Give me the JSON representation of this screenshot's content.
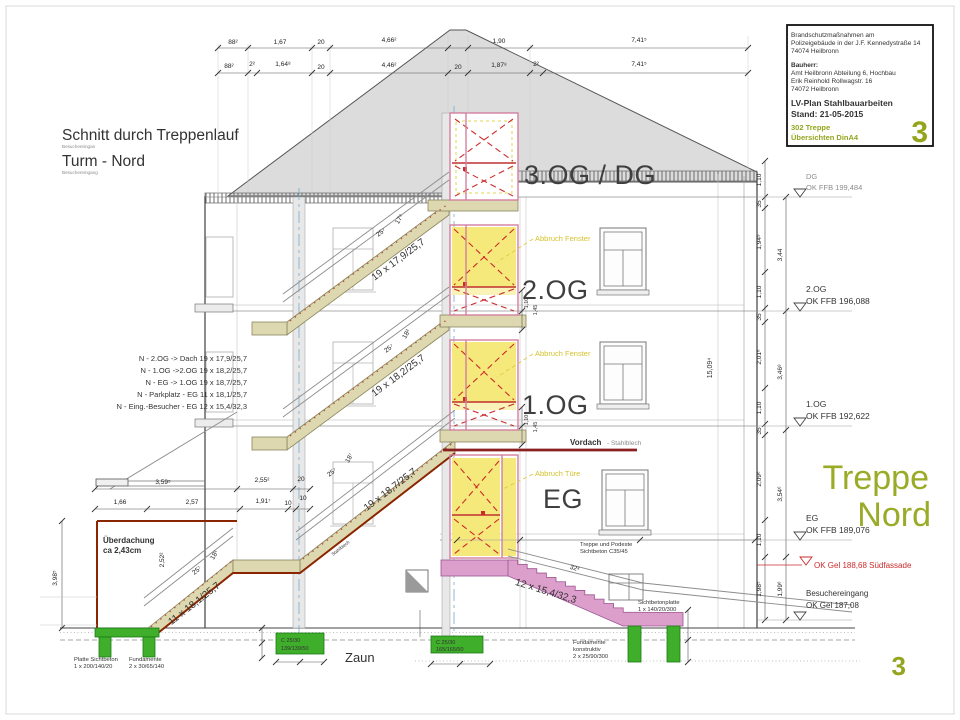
{
  "page": {
    "sheet_number": "3"
  },
  "title_block": {
    "project_l1": "Brandschutzmaßnahmen am",
    "project_l2": "Polizeigebäude in der J.F. Kennedystraße 14",
    "project_l3": "74074 Heilbronn",
    "bauherr_label": "Bauherr:",
    "bauherr_l1": "Amt Heilbronn  Abteilung 6, Hochbau",
    "bauherr_l2": "Erik Reinhold    Rollwagstr. 16",
    "bauherr_l3": "74072 Heilbronn",
    "plan": "LV-Plan Stahlbauarbeiten",
    "stand": "Stand:  21-05-2015",
    "pos1": "302 Treppe",
    "pos2": "Übersichten DinA4",
    "sheet": "3"
  },
  "drawing_title": {
    "main": "Schnitt durch Treppenlauf",
    "main_sub": "Besuchereingan",
    "sub": "Turm - Nord",
    "sub_sub": "Besuchereingang"
  },
  "stair_schedule": [
    "N - 2.OG -> Dach  19 x 17,9/25,7",
    "N - 1.OG ->2.OG  19 x 18,2/25,7",
    "N - EG -> 1.OG  19 x 18,7/25,7",
    "N - Parkplatz - EG  11 x 18,1/25,7",
    "N - Eing.-Besucher - EG 12 x 15,4/32,3"
  ],
  "floors": {
    "dg": "3.OG / DG",
    "og2": "2.OG",
    "og1": "1.OG",
    "eg": "EG"
  },
  "levels": {
    "dg_name": "DG",
    "dg_val": "OK FFB 199,484",
    "og2_name": "2.OG",
    "og2_val": "OK FFB 196,088",
    "og1_name": "1.OG",
    "og1_val": "OK FFB 192,622",
    "eg_name": "EG",
    "eg_val": "OK FFB 189,076",
    "gel_red": "OK Gel 188,68 Südfassade",
    "entry_name": "Besuchereingang",
    "entry_val": "OK Gel 187,08"
  },
  "side_title": {
    "l1": "Treppe",
    "l2": "Nord"
  },
  "annotations": {
    "abbruch_fenster": "Abbruch Fenster",
    "abbruch_tuere": "Abbruch Türe",
    "vordach": "Vordach",
    "vordach_sub": "- Stahlblech",
    "stahlblech": "Stahlblech",
    "ueberdachung_l1": "Überdachung",
    "ueberdachung_l2": "ca 2,43cm",
    "zaun": "Zaun",
    "treppe_podeste_l1": "Treppe und Podeste",
    "treppe_podeste_l2": "Sichtbeton  C35/45",
    "sichtbetonplatte_l1": "Sichtbetonplatte",
    "sichtbetonplatte_l2": "1 x 140/20/300",
    "fund_konstr_l1": "Fundamente",
    "fund_konstr_l2": "konstruktiv",
    "fund_konstr_l3": "2 x 25/90/300",
    "platte_l1": "Platte Sichtbeton",
    "platte_l2": "1 x 200/140/20",
    "fundamente_l1": "Fundamente",
    "fundamente_l2": "2 x 30/65/140",
    "c1_l1": "C 25/30",
    "c1_l2": "139/139/50",
    "c2_l1": "C 25/30",
    "c2_l2": "165/165/50"
  },
  "flights": {
    "f_dach": "19 x 17,9/25,7",
    "f_og2": "19 x 18,2/25,7",
    "f_og1": "19 x 18,7/25,7",
    "f_park": "11 x 18,1/25,7",
    "f_bes": "12 x 15,4/32,3",
    "tread": "25⁷",
    "rise_dach": "17⁹",
    "rise_og2": "18²",
    "rise_og1": "18⁷",
    "rise_park": "18¹",
    "tread_bes": "32³"
  },
  "dims": {
    "top1": [
      "88²",
      "1,67",
      "20",
      "4,66²",
      "1,90",
      "7,41⁵"
    ],
    "top2": [
      "88²",
      "2²",
      "1,64⁸",
      "20",
      "4,46²",
      "20",
      "1,87⁸",
      "2²",
      "7,41⁵"
    ],
    "right_inner": [
      "1,10",
      "35",
      "1,94⁹",
      "1,10",
      "35",
      "2,01⁶",
      "1,10",
      "35",
      "2,09⁶",
      "1,10",
      "1,98⁵"
    ],
    "right_outer": [
      "3,44",
      "3,46⁸",
      "3,54⁶",
      "1,99⁶"
    ],
    "total": "15,09⁴",
    "left_v": "3,98⁵",
    "l_row1": [
      "3,59⁵",
      "2,55²",
      "20"
    ],
    "l_row2": [
      "1,66",
      "2,57",
      "1,91⁷",
      "10",
      "10"
    ],
    "v252": "2,52²",
    "v110": "1,10",
    "v145": "1,45"
  },
  "colors": {
    "brand_green": "#94a51d",
    "treppe_green": "#9aab27",
    "abbruch_yellow": "#f6e97b",
    "demolition_red": "#cc2b2b",
    "vordach_red": "#8b2500",
    "stair_beige": "#ded8b0",
    "concrete_pink": "#dc9fcb",
    "foundation_green": "#3fae2a",
    "axis_blue": "#74aacd"
  }
}
